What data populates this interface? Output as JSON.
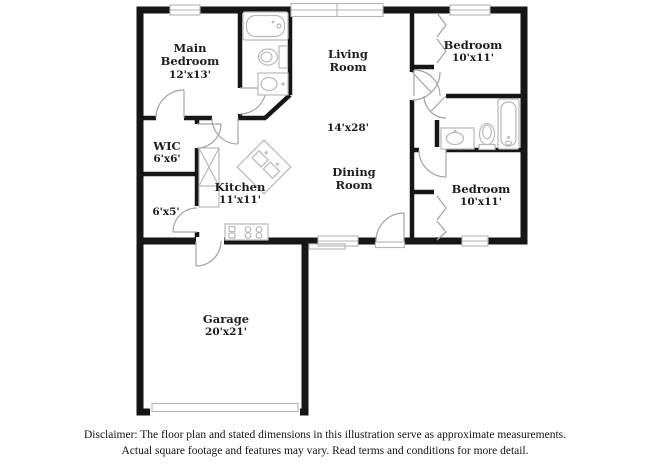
{
  "rooms": {
    "main_bedroom": {
      "line1": "Main",
      "line2": "Bedroom",
      "dims": "12'x13'"
    },
    "living_room": {
      "line1": "Living",
      "line2": "Room",
      "dims": "14'x28'"
    },
    "bedroom_top_right": {
      "line1": "Bedroom",
      "dims": "10'x11'"
    },
    "wic": {
      "line1": "WIC",
      "dims": "6'x6'"
    },
    "kitchen": {
      "line1": "Kitchen",
      "dims": "11'x11'"
    },
    "hall_closet": {
      "dims": "6'x5'"
    },
    "dining_room": {
      "line1": "Dining",
      "line2": "Room"
    },
    "bedroom_bottom_right": {
      "line1": "Bedroom",
      "dims": "10'x11'"
    },
    "garage": {
      "line1": "Garage",
      "dims": "20'x21'"
    }
  },
  "disclaimer": {
    "line1": "Disclaimer: The floor plan and stated dimensions in this illustration serve as approximate measurements.",
    "line2": "Actual square footage and features may vary. Read terms and conditions for more detail."
  },
  "colors": {
    "wall": "#161616",
    "fixture": "#b9b9b9",
    "door_swing": "#a3a3a3",
    "text": "#1e1e1e",
    "background": "#ffffff"
  }
}
